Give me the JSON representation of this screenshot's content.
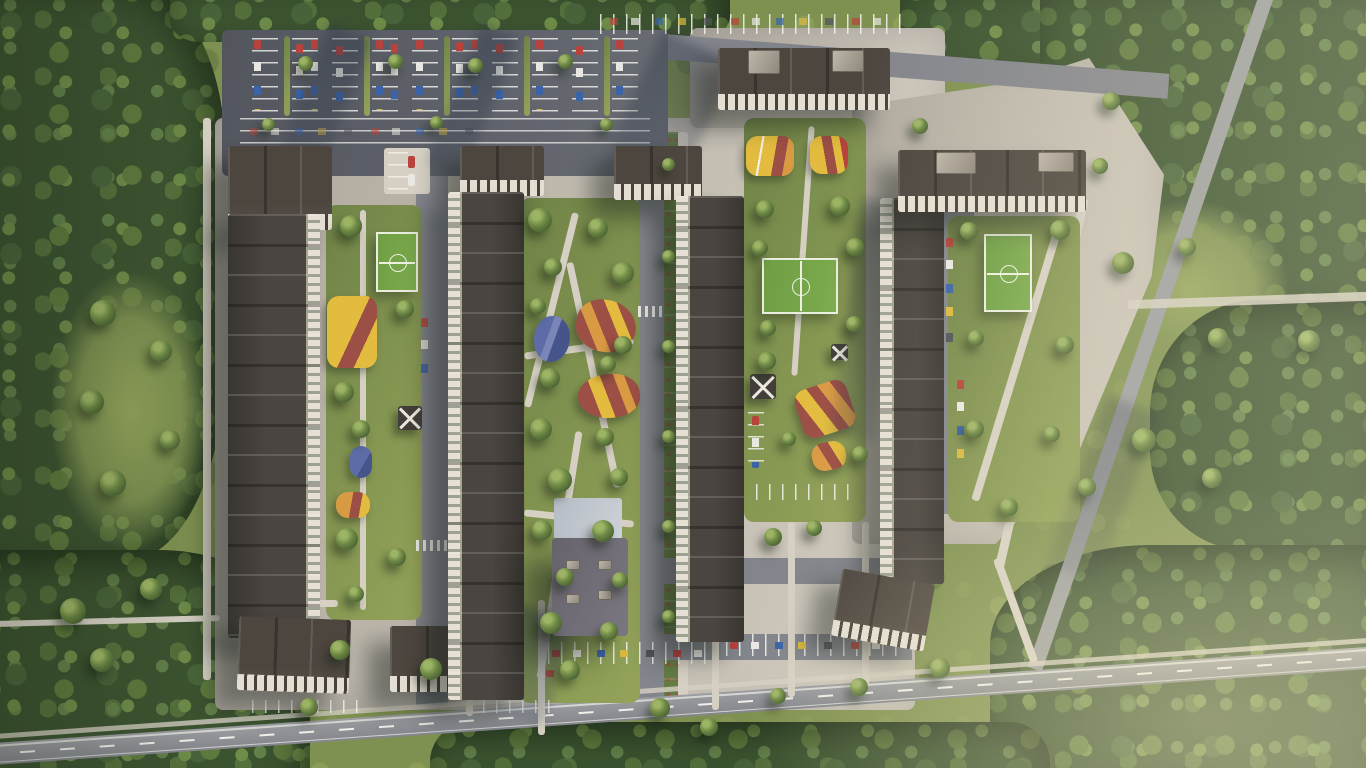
{
  "scene": {
    "type": "aerial-architectural-render",
    "subject": "Top-down aerial render of a residential complex master plan at golden hour, surrounded by forest",
    "lighting": "Low sun from the upper right; long soft shadows cast toward lower left",
    "inventory": {
      "apartment_buildings": 7,
      "football_pitches": 3,
      "playgrounds": 10,
      "surface_parking_lots": 5,
      "school_building": 1,
      "pavilions": 3,
      "roads": [
        "main road along bottom with dashed centerline",
        "diagonal road through forest on the right",
        "internal streets with parallel parking",
        "central boulevard with planted median"
      ],
      "landscape": [
        "dense forest belt on the left",
        "forest strip along the top",
        "forest masses on the right and bottom",
        "courtyard lawns with scattered trees",
        "central linear park with winding paths"
      ]
    }
  },
  "palette": {
    "grass": "#7f9150",
    "grass_shade": "#5c7340",
    "forest": "#3c5330",
    "canopy_light": "#7e9750",
    "asphalt": "#83858c",
    "asphalt_dark": "#565a62",
    "pavement": "#c7c1b6",
    "pavement_light": "#d6d0c4",
    "roof_dark": "#4a4540",
    "roof_mid": "#5a544d",
    "facade": "#e6e0d4",
    "school_roof": "#6e6a74",
    "pitch_green": "#6e9d44",
    "play_yellow": "#e3bc3f",
    "play_red": "#9c4f45",
    "play_orange": "#d99a44",
    "play_blue": "#5d6ca6",
    "line_white": "#f0efe9"
  }
}
